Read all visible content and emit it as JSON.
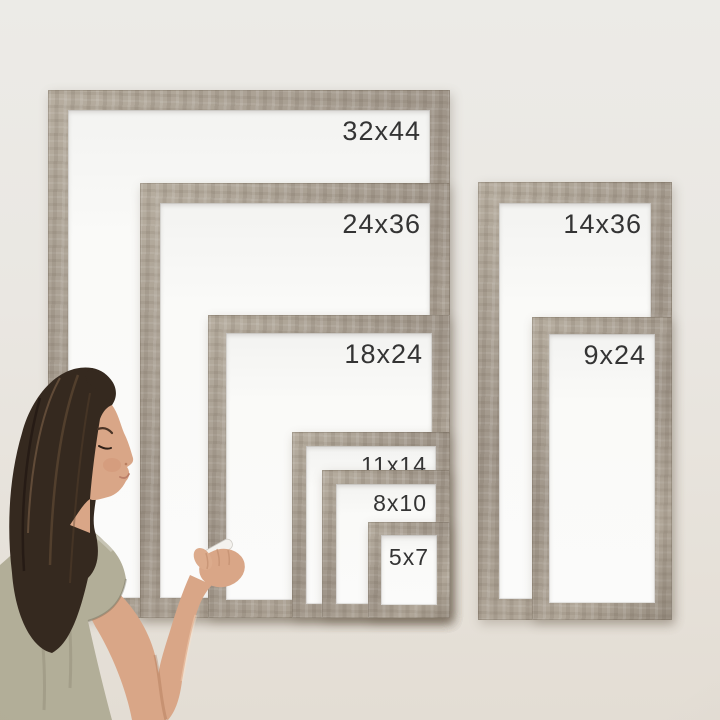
{
  "frames": [
    {
      "name": "frame-32x44",
      "label": "32x44"
    },
    {
      "name": "frame-24x36",
      "label": "24x36"
    },
    {
      "name": "frame-18x24",
      "label": "18x24"
    },
    {
      "name": "frame-11x14",
      "label": "11x14"
    },
    {
      "name": "frame-8x10",
      "label": "8x10"
    },
    {
      "name": "frame-5x7",
      "label": "5x7"
    },
    {
      "name": "frame-14x36",
      "label": "14x36"
    },
    {
      "name": "frame-9x24",
      "label": "9x24"
    }
  ],
  "colors": {
    "wall": "#eae7e2",
    "wood": "#a79d90",
    "board": "#fafaf8",
    "label_text": "#343434",
    "hair": "#35291f",
    "skin": "#d9a687",
    "shirt": "#b2ae98",
    "marker": "#f4f2ee"
  }
}
